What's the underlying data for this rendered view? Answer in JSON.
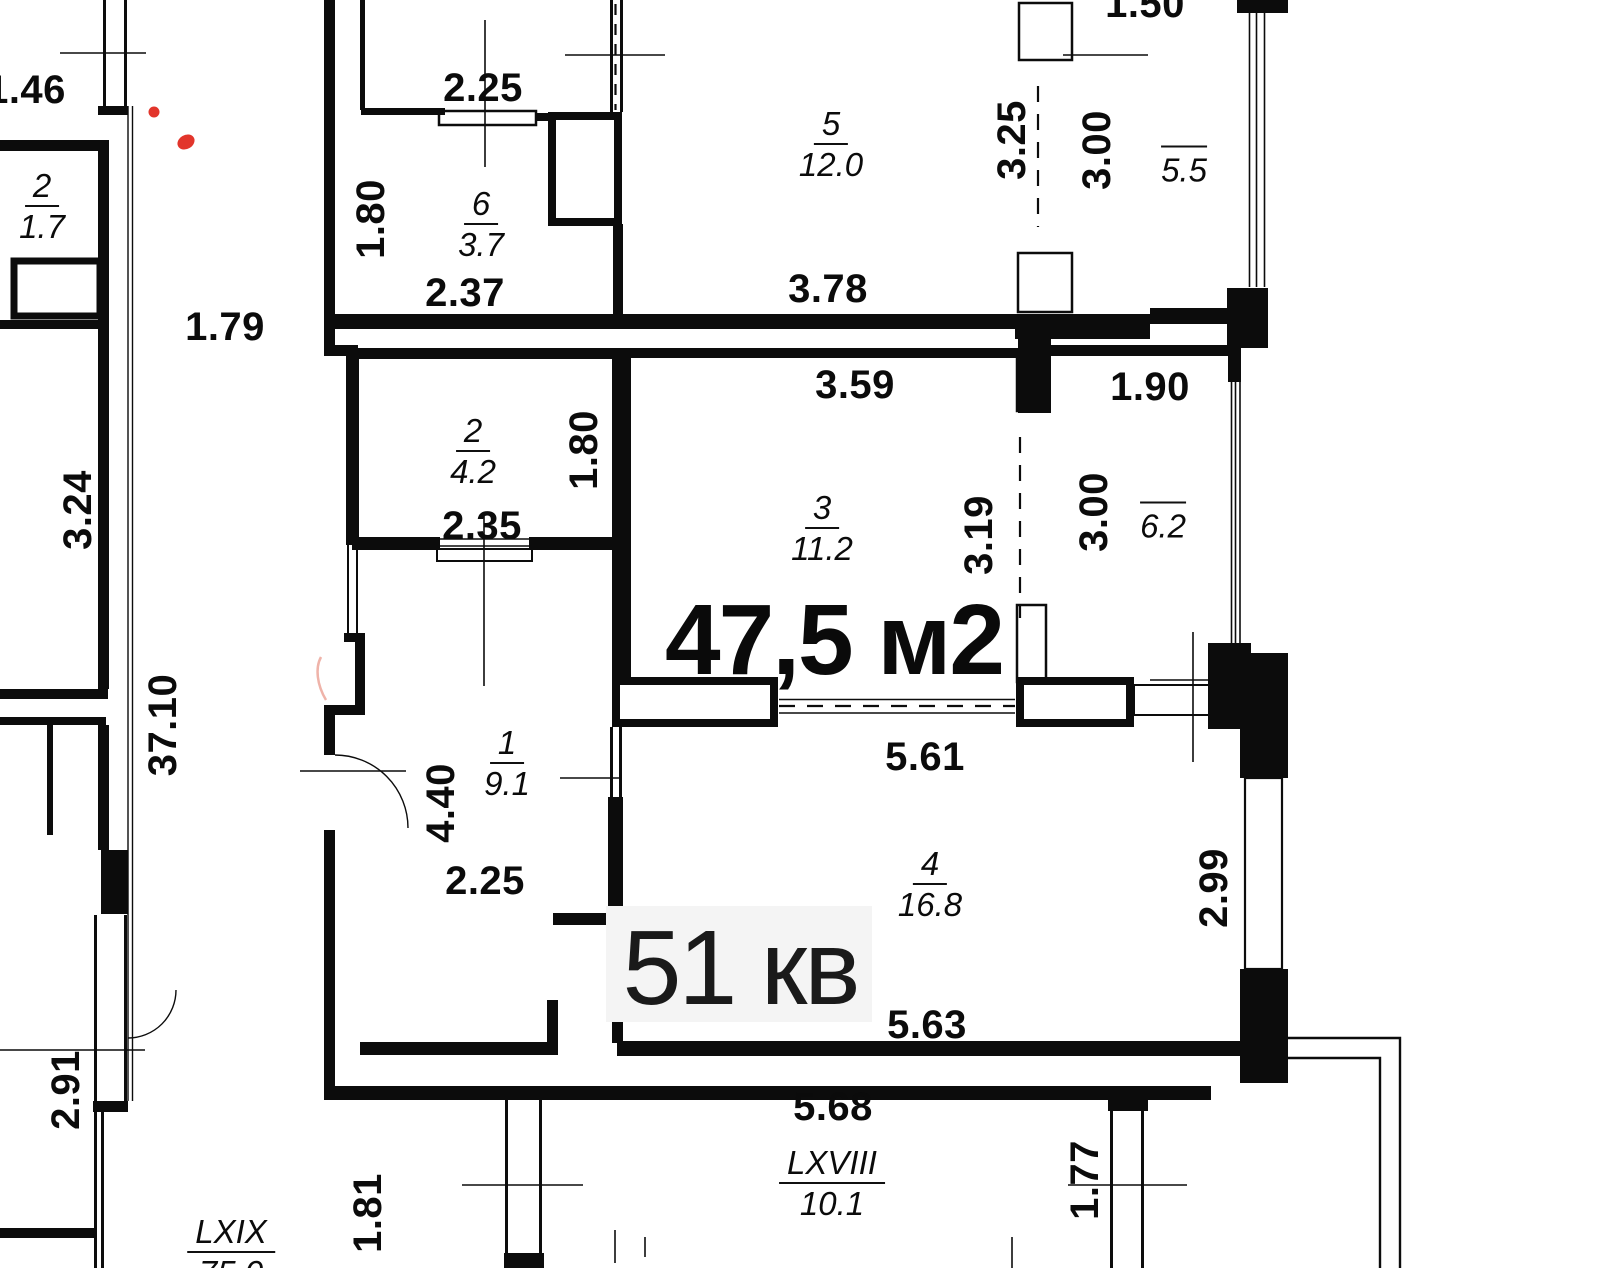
{
  "colors": {
    "wall": "#0c0c0c",
    "red_mark": "#e2352b",
    "apartment_box": "#f4f4f4"
  },
  "big_labels": {
    "total_area": "47,5 м2",
    "apartment": "51 кв"
  },
  "dimensions": [
    {
      "text": "1.46"
    },
    {
      "text": "2.25"
    },
    {
      "text": "1.50"
    },
    {
      "text": "1.80"
    },
    {
      "text": "2.37"
    },
    {
      "text": "3.78"
    },
    {
      "text": "3.25"
    },
    {
      "text": "3.00"
    },
    {
      "text": "1.79"
    },
    {
      "text": "3.59"
    },
    {
      "text": "1.90"
    },
    {
      "text": "1.80"
    },
    {
      "text": "2.35"
    },
    {
      "text": "3.19"
    },
    {
      "text": "3.00"
    },
    {
      "text": "3.24"
    },
    {
      "text": "37.10"
    },
    {
      "text": "4.40"
    },
    {
      "text": "2.25"
    },
    {
      "text": "5.61"
    },
    {
      "text": "2.99"
    },
    {
      "text": "2.91"
    },
    {
      "text": "5.63"
    },
    {
      "text": "5.68"
    },
    {
      "text": "1.81"
    },
    {
      "text": "1.77"
    }
  ],
  "rooms": [
    {
      "number": "2",
      "area": "1.7"
    },
    {
      "number": "6",
      "area": "3.7"
    },
    {
      "number": "5",
      "area": "12.0"
    },
    {
      "number": "2",
      "area": "4.2"
    },
    {
      "number": "3",
      "area": "11.2"
    },
    {
      "number": "1",
      "area": "9.1"
    },
    {
      "number": "4",
      "area": "16.8"
    }
  ],
  "balconies": [
    {
      "area": "5.5"
    },
    {
      "area": "6.2"
    }
  ],
  "units": [
    {
      "number": "LXVIII",
      "area": "10.1"
    },
    {
      "number": "LXIX",
      "area": "75.0"
    }
  ]
}
